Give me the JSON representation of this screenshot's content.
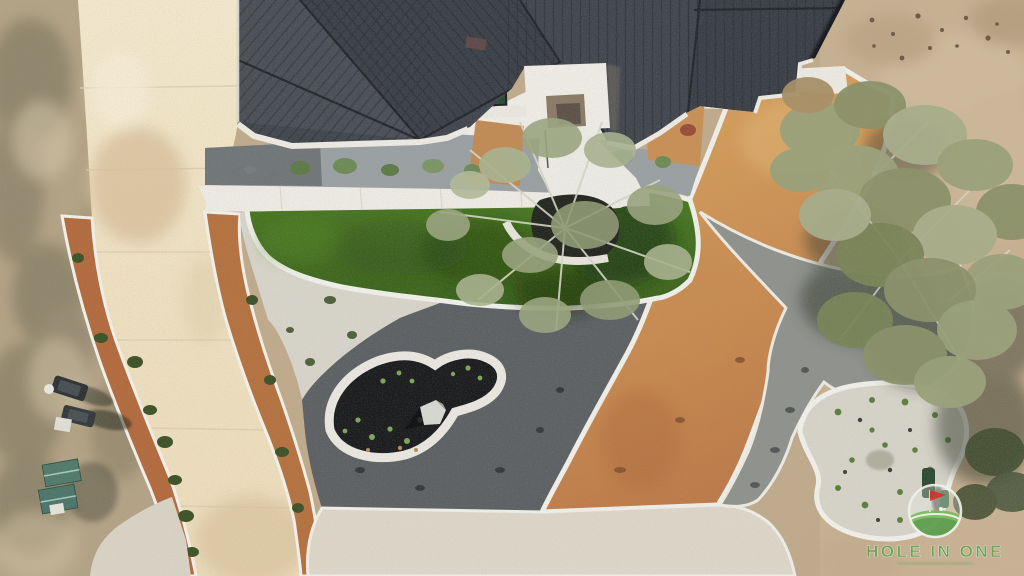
{
  "watermark": {
    "brand": "HOLE IN ONE",
    "logo": "golf-flag-on-green-icon",
    "text_color": "#64a14e"
  },
  "scene": {
    "description": "Aerial drone view of a modern home with dark standing-seam metal roof, curved cream concrete driveway edged in rust decomposed granite, artificial turf lawn, white and gray gravel beds, a black mulch island with boulder, wood-chip paths, oak trees and natural scrub terrain",
    "palette": {
      "roof": "#3f434b",
      "driveway": "#efe2c4",
      "rust_gravel": "#b46b3e",
      "turf": "#427020",
      "white_gravel": "#d7d4ca",
      "dark_gravel": "#5c6063",
      "black_mulch": "#1a1b1d",
      "wood_chips": "#d2a25e",
      "dirt": "#bfa98b",
      "white_rock": "#ded7c9",
      "shed_roof": "#4f7a6c"
    }
  }
}
